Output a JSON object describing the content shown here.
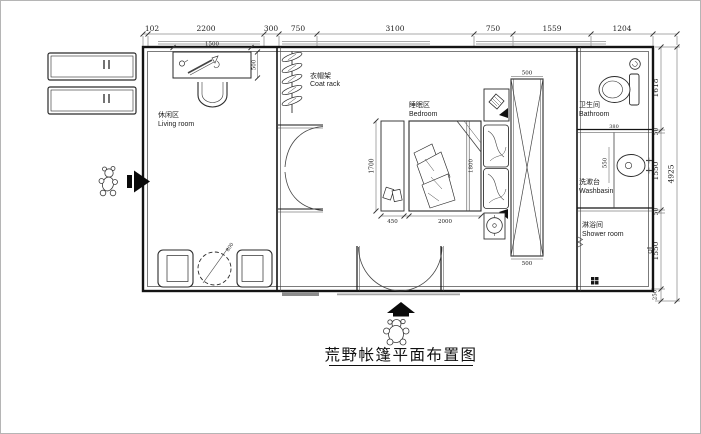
{
  "title": "荒野帐篷平面布置图",
  "rooms": {
    "living": {
      "zh": "休闲区",
      "en": "Living room"
    },
    "coat": {
      "zh": "衣帽架",
      "en": "Coat rack"
    },
    "bedroom": {
      "zh": "睡眠区",
      "en": "Bedroom"
    },
    "bathroom": {
      "zh": "卫生间",
      "en": "Bathroom"
    },
    "washbasin": {
      "zh": "洗漱台",
      "en": "Washbasin"
    },
    "shower": {
      "zh": "淋浴间",
      "en": "Shower room"
    }
  },
  "dims": {
    "top": {
      "a": "102",
      "b": "2200",
      "c": "300",
      "d": "750",
      "e": "3100",
      "f": "750",
      "g": "1559",
      "h": "1204"
    },
    "right": {
      "a": "1618",
      "b": "50",
      "c": "1550",
      "d": "50",
      "e": "1550",
      "f": "250",
      "total": "4925"
    },
    "bed": {
      "length": "1700",
      "rug": "450",
      "width": "2000",
      "inner": "1800"
    },
    "desk": {
      "width": "1500",
      "depth": "500"
    },
    "table": {
      "diameter": "800"
    },
    "wardrobe": {
      "top": "500",
      "bottom": "500"
    },
    "bathroom": {
      "a": "380"
    },
    "washbasin": {
      "a": "550"
    }
  }
}
